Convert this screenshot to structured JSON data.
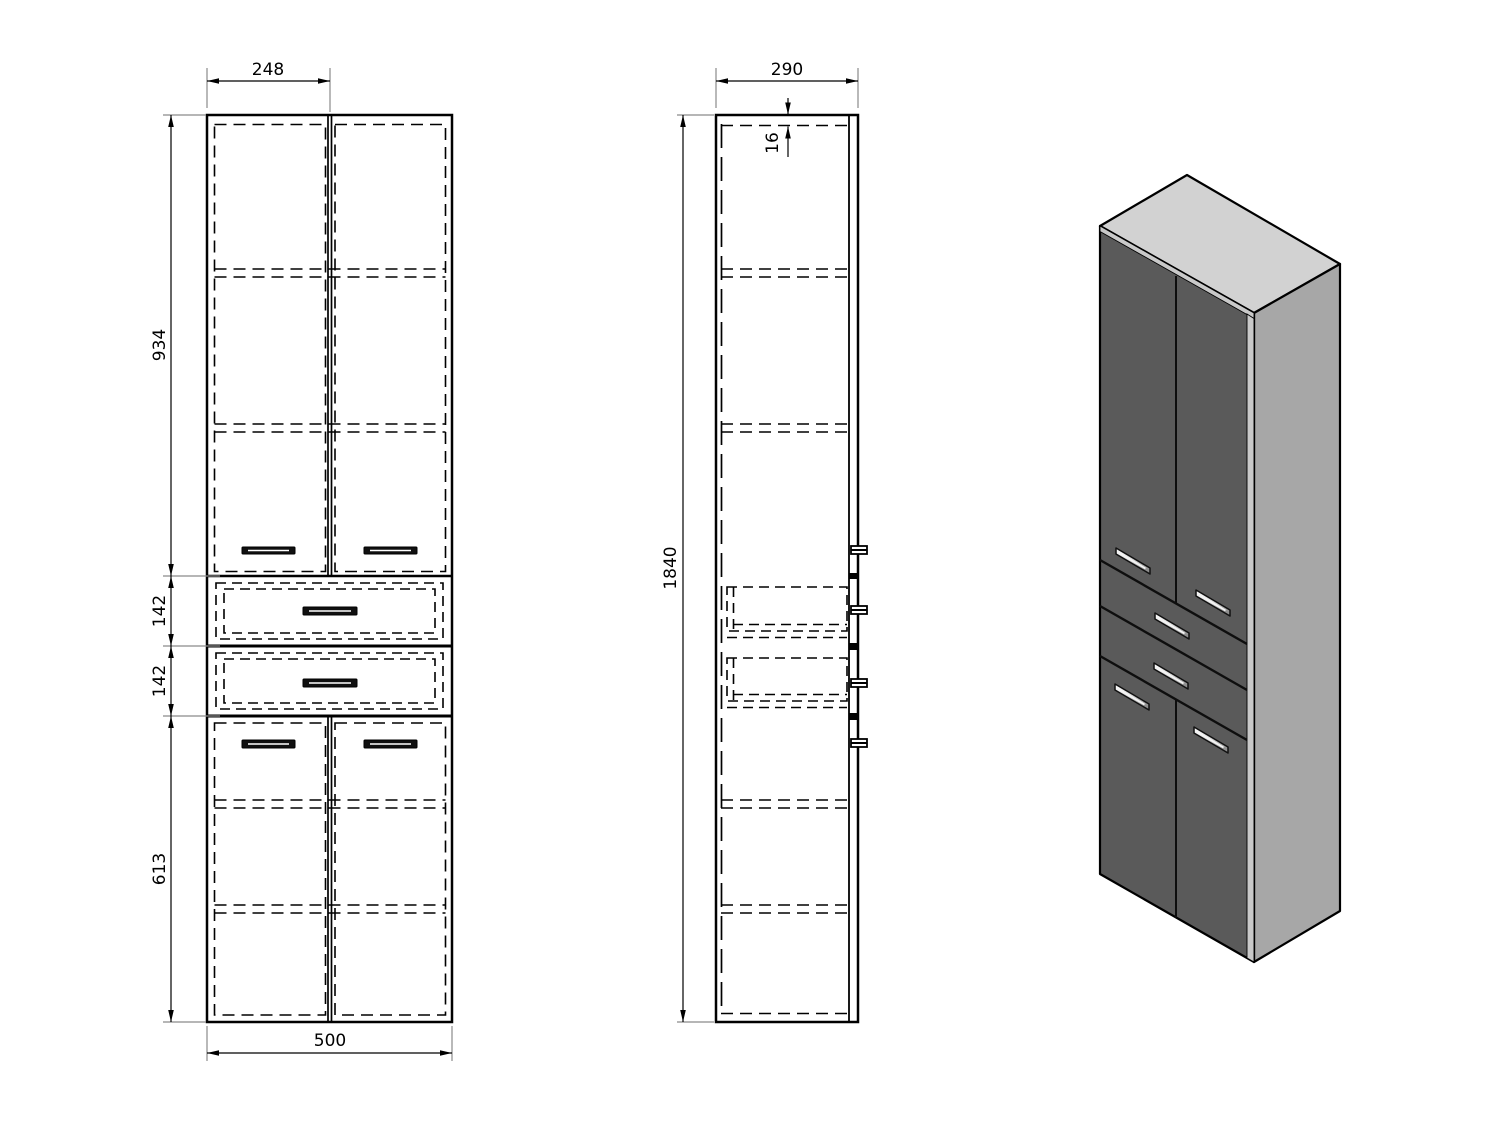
{
  "drawing": {
    "dimensions": {
      "front_half_width": "248",
      "front_upper_door_height": "934",
      "front_drawer_top_height": "142",
      "front_drawer_bottom_height": "142",
      "front_lower_door_height": "613",
      "front_total_width": "500",
      "side_depth": "290",
      "side_top_panel_thickness": "16",
      "side_total_height": "1840"
    },
    "colors": {
      "background": "#ffffff",
      "line": "#000000",
      "extension_line": "#8a8a8a",
      "iso_front_face": "#5a5a5a",
      "iso_side_face": "#a7a7a7",
      "iso_top_face": "#d2d2d2",
      "iso_edge_strip": "#c9c9c9",
      "handle_highlight": "#f4f4f4"
    }
  }
}
